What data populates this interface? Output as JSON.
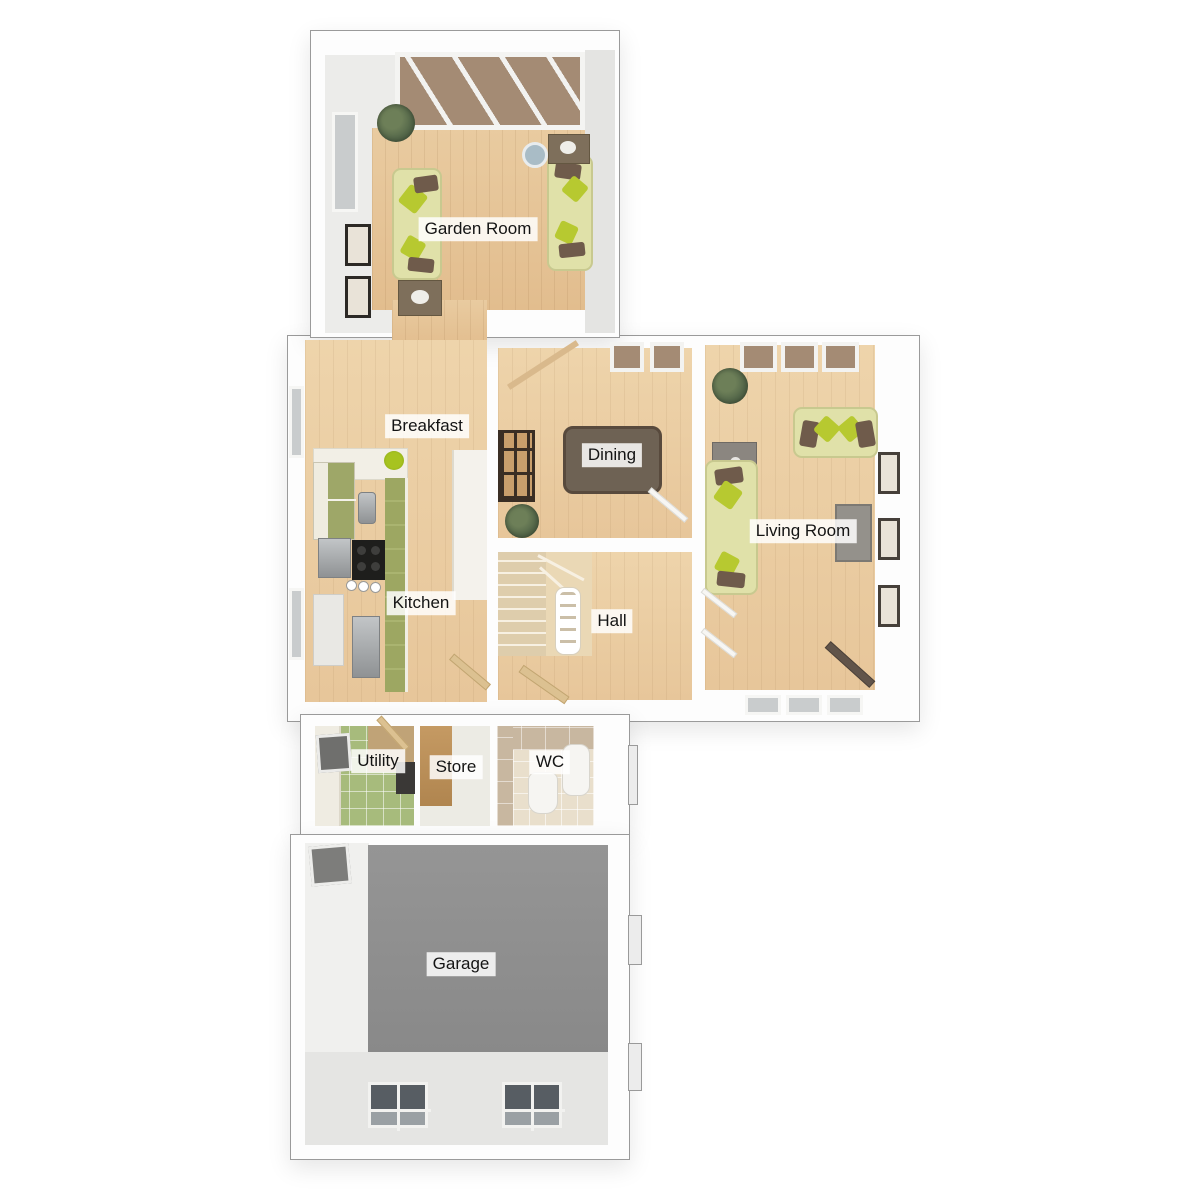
{
  "plan": {
    "type": "3d-floorplan-top-view",
    "floor_label_style": "white tag with black text"
  },
  "rooms": [
    {
      "id": "garden-room",
      "label": "Garden Room"
    },
    {
      "id": "breakfast",
      "label": "Breakfast"
    },
    {
      "id": "dining",
      "label": "Dining"
    },
    {
      "id": "living-room",
      "label": "Living Room"
    },
    {
      "id": "kitchen",
      "label": "Kitchen"
    },
    {
      "id": "hall",
      "label": "Hall"
    },
    {
      "id": "utility",
      "label": "Utility"
    },
    {
      "id": "store",
      "label": "Store"
    },
    {
      "id": "wc",
      "label": "WC"
    },
    {
      "id": "garage",
      "label": "Garage"
    }
  ],
  "palette": {
    "background": "#ffffff",
    "wall_white": "#fdfdfd",
    "outline_gray": "#9a9a9a",
    "wood_floor": "#e6c598",
    "wood_floor_light": "#ecd0a6",
    "garage_floor": "#8d8d8d",
    "garage_apron": "#e5e5e3",
    "utility_tile_green": "#a7bb7c",
    "wc_tile_tan": "#c8b7a0",
    "wc_floor_beige": "#e9dfcc",
    "store_wall_tan": "#bd9057",
    "sofa_green": "#e0e1a9",
    "cushion_brown": "#6f5b4b",
    "cushion_lime": "#b7c930",
    "dining_table_brown": "#6e6254",
    "chair_cream": "#eae3d0",
    "kitchen_unit_green": "#9da762",
    "counter_cream": "#f2efe6",
    "roof_glass_brown": "#a48b74",
    "plant_green": "#55684a"
  }
}
